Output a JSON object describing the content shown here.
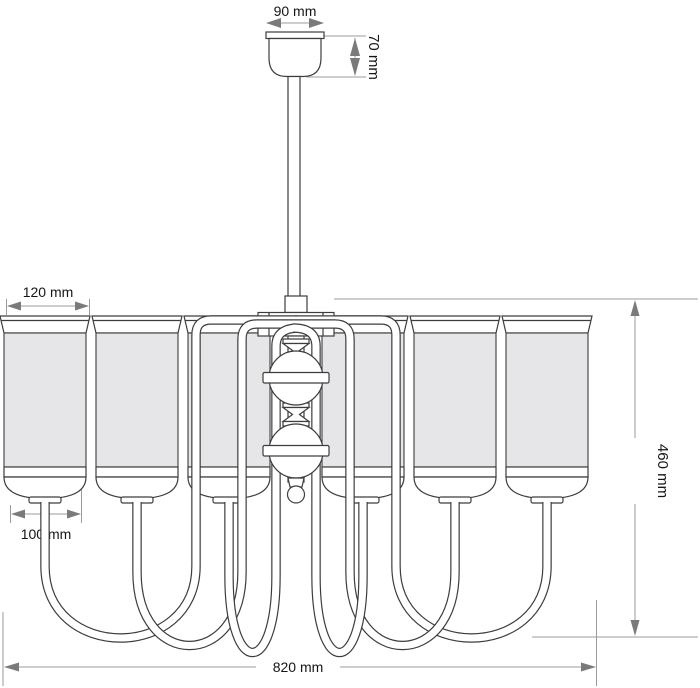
{
  "figure": {
    "kind": "technical-line-drawing",
    "subject": "six-arm chandelier with cylindrical fabric shades, front elevation with dimensions"
  },
  "dimensions": {
    "canopy_width": "90 mm",
    "canopy_height": "70 mm",
    "shade_top_diameter": "120 mm",
    "shade_bottom_diameter": "100 mm",
    "fixture_height": "460 mm",
    "total_width": "820 mm"
  },
  "colors": {
    "outline": "#3d3d3d",
    "shade_fill": "#e6e6e8",
    "dimension_line": "#9b9b9b",
    "arrowhead": "#7a7a7a",
    "text": "#151515",
    "background": "#ffffff"
  }
}
